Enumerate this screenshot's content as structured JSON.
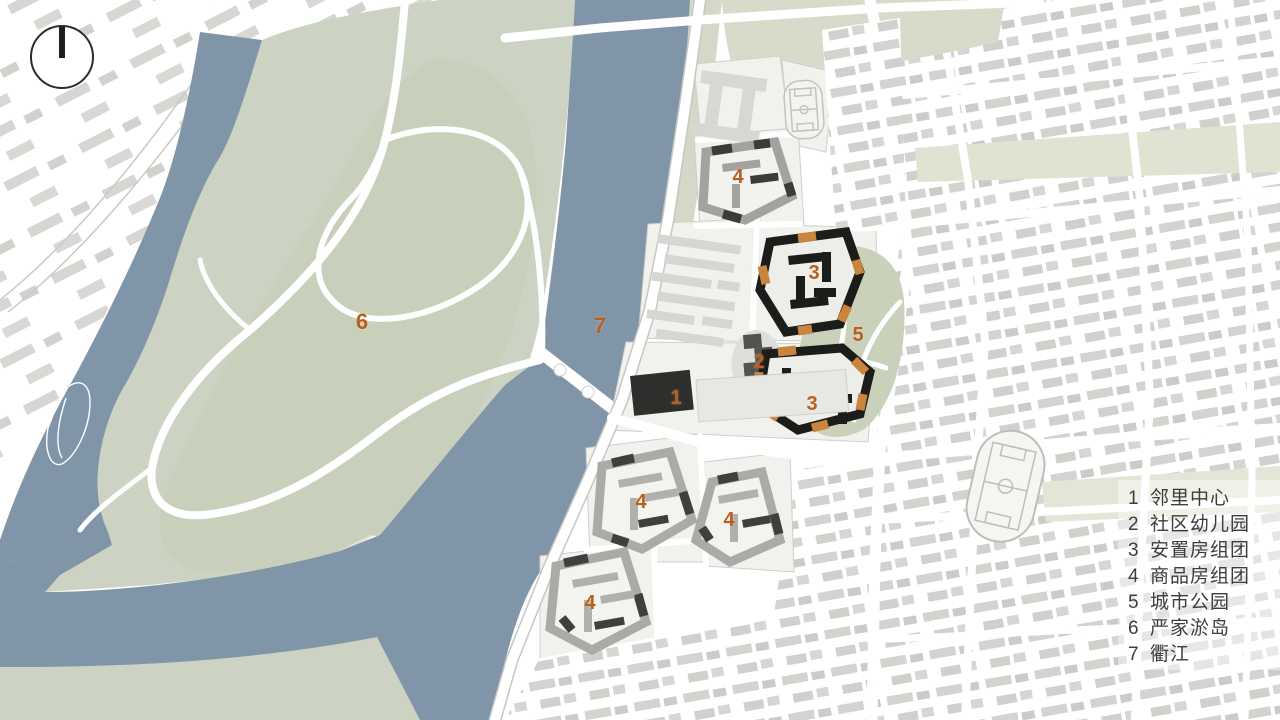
{
  "title": "residential-district-masterplan",
  "legend": {
    "items": [
      {
        "num": "1",
        "label": "邻里中心"
      },
      {
        "num": "2",
        "label": "社区幼儿园"
      },
      {
        "num": "3",
        "label": "安置房组团"
      },
      {
        "num": "4",
        "label": "商品房组团"
      },
      {
        "num": "5",
        "label": "城市公园"
      },
      {
        "num": "6",
        "label": "严家淤岛"
      },
      {
        "num": "7",
        "label": "衢江"
      }
    ]
  },
  "markers": [
    {
      "num": "1"
    },
    {
      "num": "2"
    },
    {
      "num": "3"
    },
    {
      "num": "3"
    },
    {
      "num": "4"
    },
    {
      "num": "4"
    },
    {
      "num": "4"
    },
    {
      "num": "4"
    },
    {
      "num": "5"
    },
    {
      "num": "6"
    },
    {
      "num": "7"
    }
  ],
  "icons": {
    "north_arrow": "compass-north-icon"
  },
  "colors": {
    "river": "#8095a8",
    "island_green": "#cdd3c2",
    "park_green": "#c9d1bb",
    "band_green": "#dfe4d2",
    "city_building": "#d2d3cf",
    "new_block_gray": "#a5a5a2",
    "new_block_dark": "#3c3c3a",
    "cluster_black": "#1c1c1a",
    "cluster_orange": "#c9843e",
    "marker_orange": "#b95f1f",
    "legend_text": "#3d3d3d"
  }
}
